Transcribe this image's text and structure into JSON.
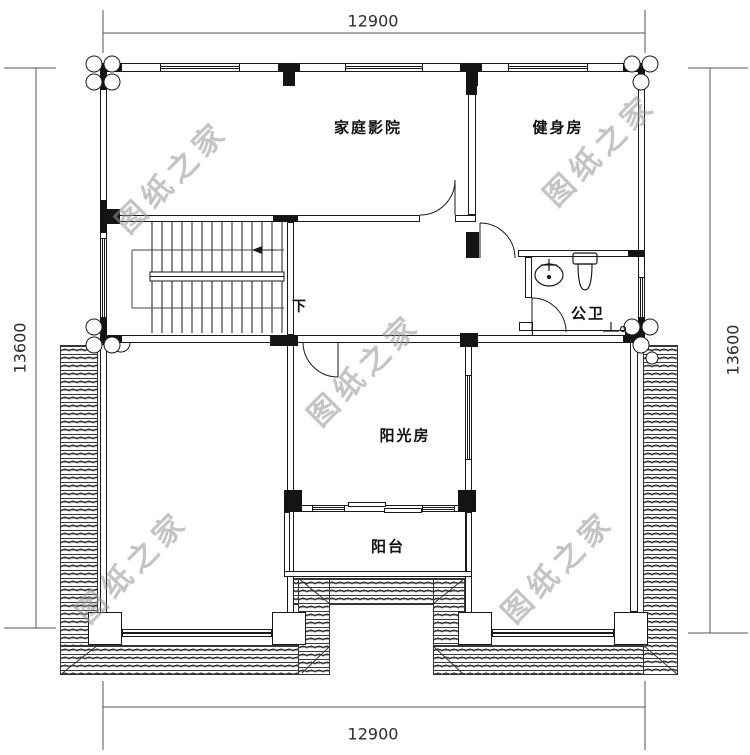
{
  "dimensions": {
    "top": "12900",
    "bottom": "12900",
    "left": "13600",
    "right": "13600"
  },
  "rooms": {
    "home_theater": "家庭影院",
    "gym": "健身房",
    "bathroom": "公卫",
    "sunroom": "阳光房",
    "balcony": "阳台",
    "stairs_direction": "下"
  },
  "watermark": {
    "text": "图纸之家",
    "color": "#949494"
  },
  "colors": {
    "line": "#1a1a1a",
    "dim_line": "#555555",
    "hatch": "#3a3a3a"
  }
}
